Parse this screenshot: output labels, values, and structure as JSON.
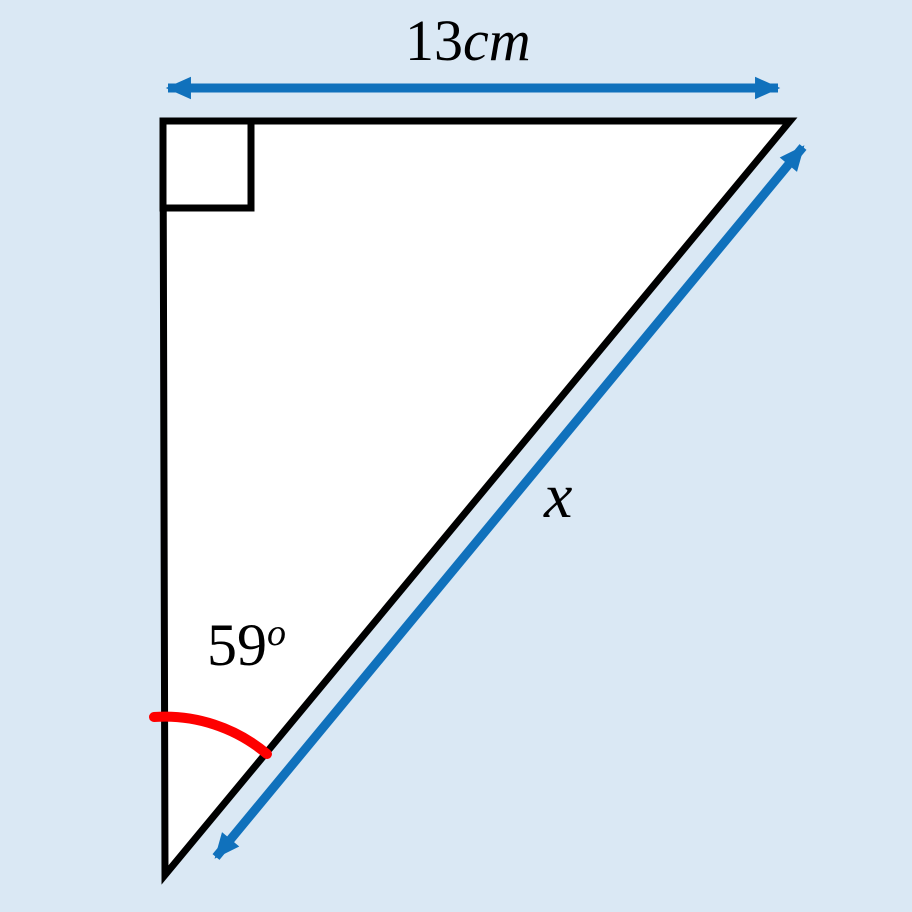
{
  "figure": {
    "type": "right-triangle-trigonometry-diagram",
    "background_color": "#DAE8F4",
    "shape_fill": "#FFFFFF",
    "outline_color": "#000000",
    "arrow_color": "#1071BC",
    "angle_arc_color": "#FE0000",
    "top_side": {
      "value": "13",
      "unit": "cm"
    },
    "hypotenuse_label": "x",
    "angle": {
      "value": "59",
      "symbol": "o"
    }
  }
}
